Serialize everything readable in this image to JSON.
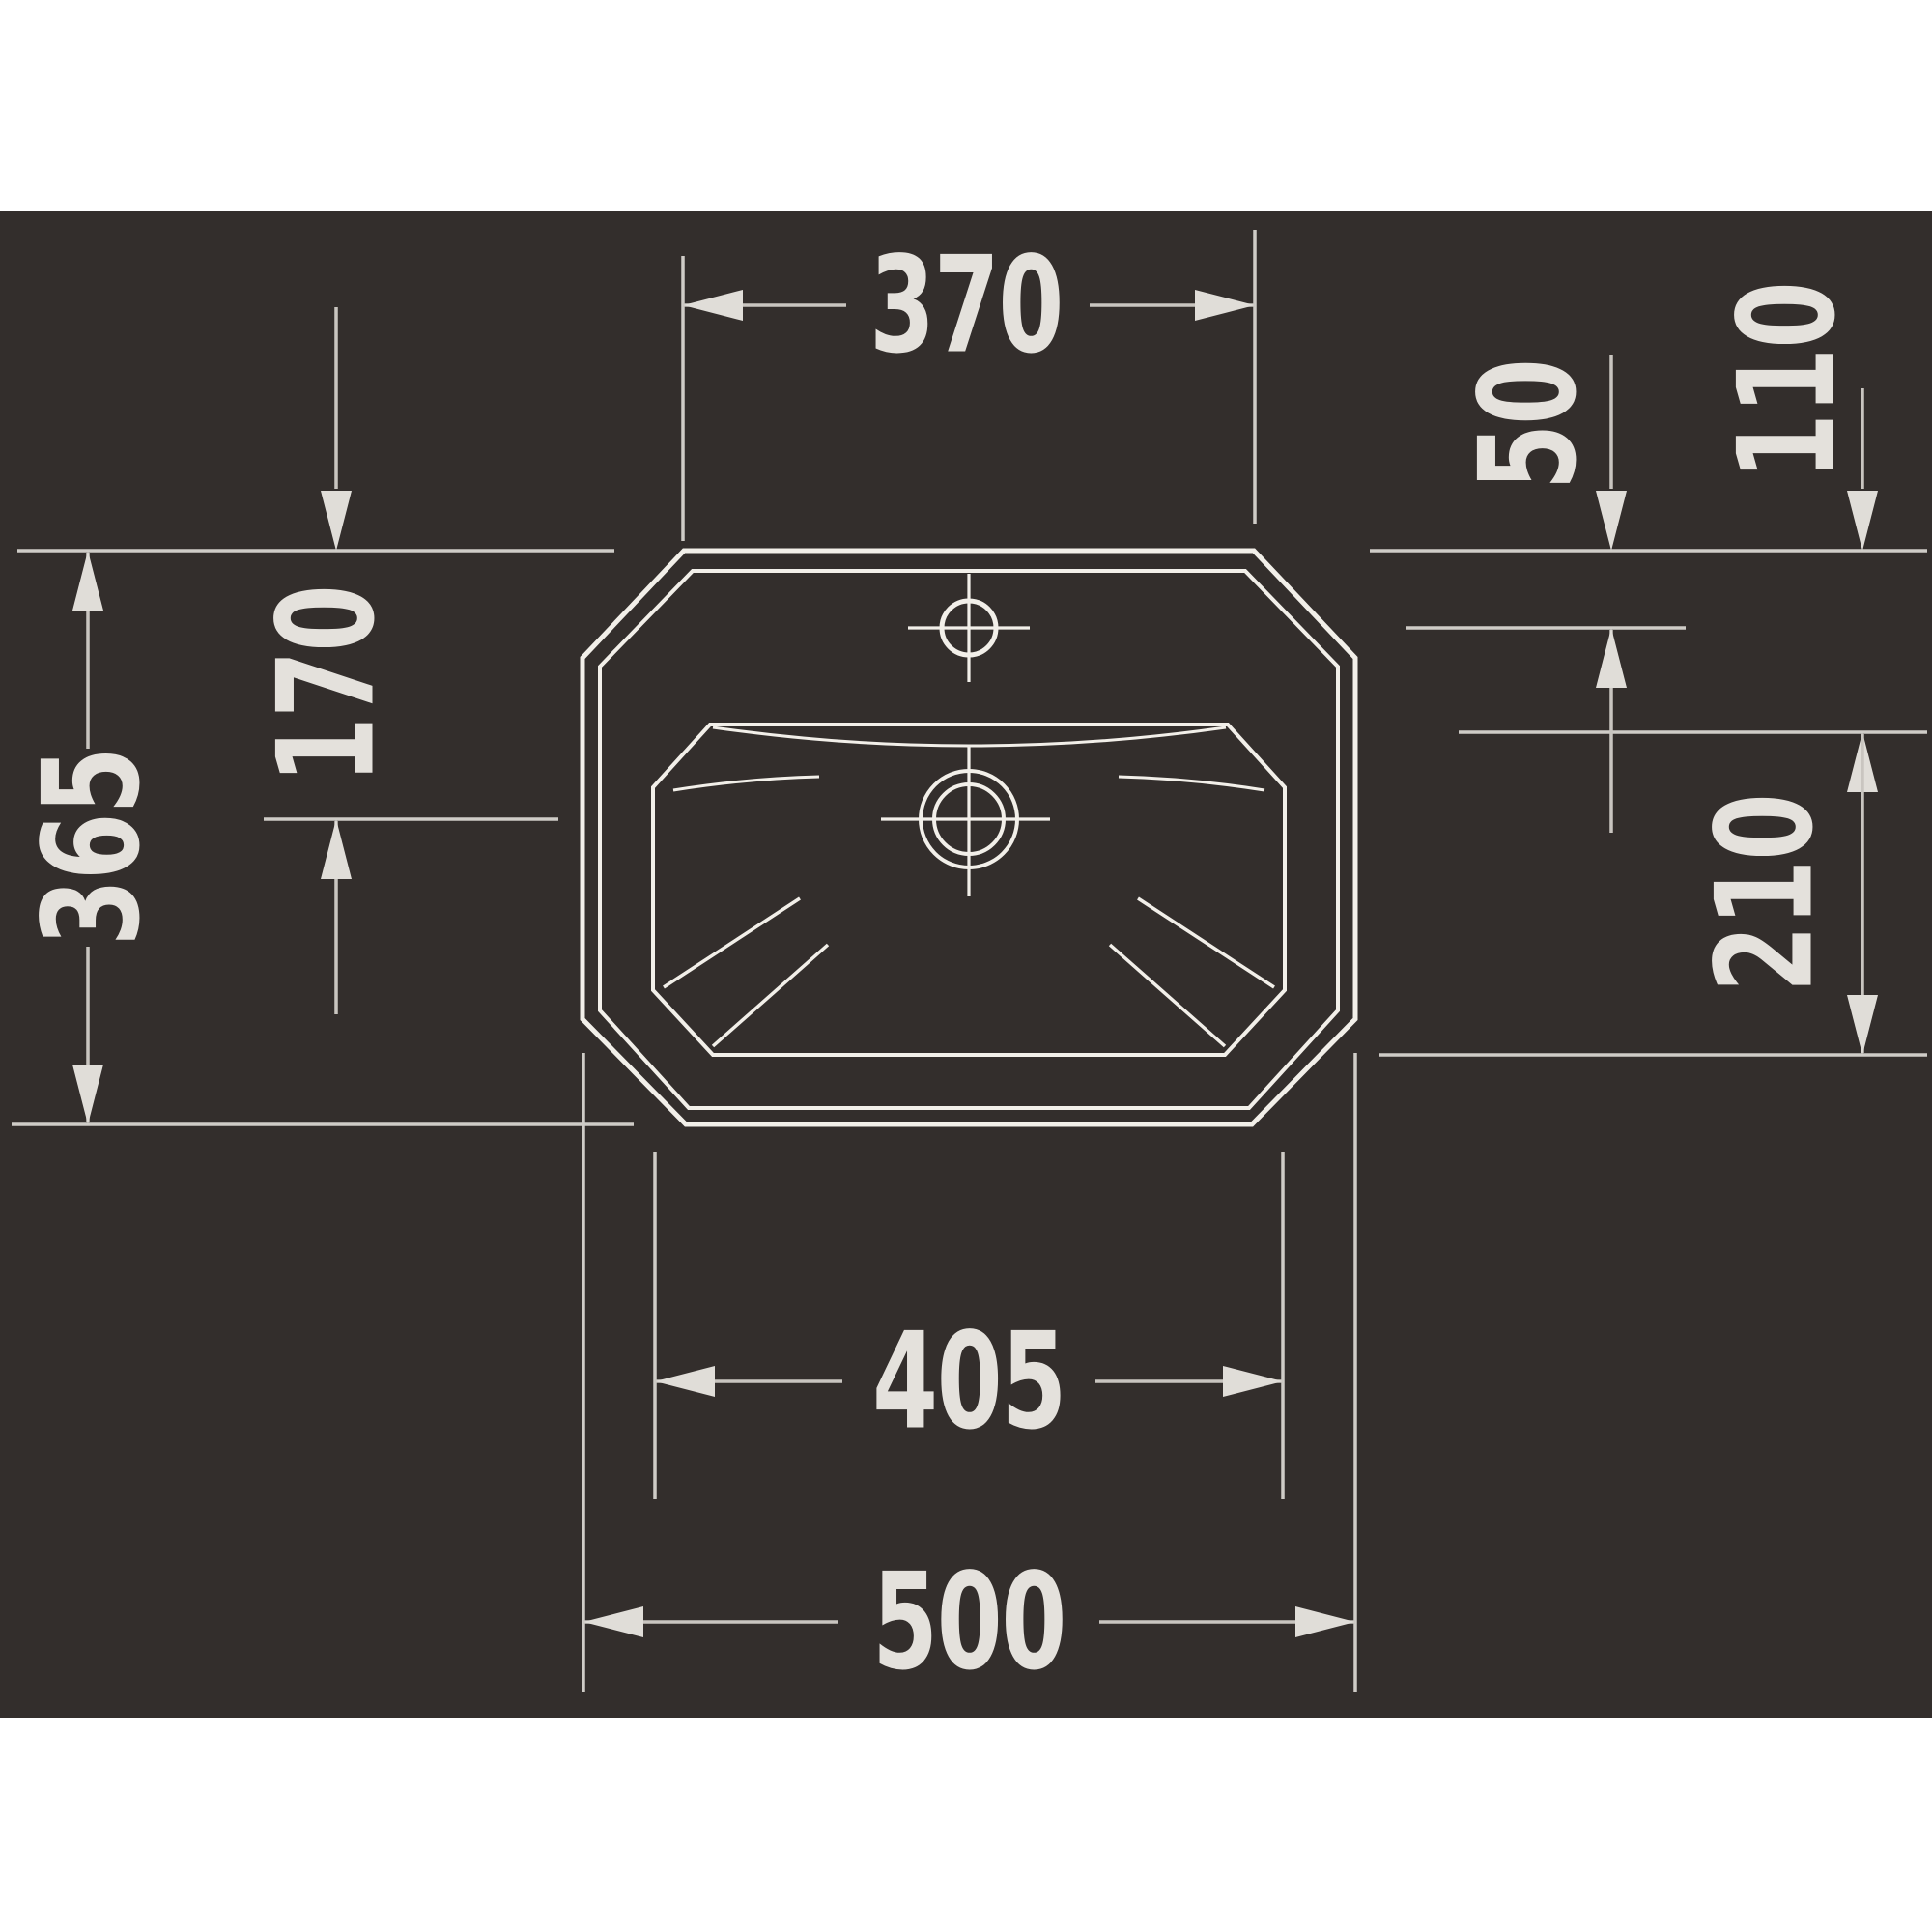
{
  "drawing": {
    "type": "technical-dimension-drawing",
    "view": "washbasin-top-view",
    "dimensions": {
      "top_edge_width": "370",
      "tap_hole_from_back_edge": "50",
      "basin_top_from_back_edge": "110",
      "drain_center_from_back_edge": "170",
      "overall_depth": "365",
      "basin_depth": "210",
      "basin_width": "405",
      "overall_width": "500"
    },
    "colors": {
      "page": "#ffffff",
      "background": "#332e2c",
      "outline": "#f2efe9",
      "dimline": "#c9c5c0",
      "extline": "#cfccc7",
      "dimtext": "#e4e1dc",
      "arrow": "#e0ddd8"
    }
  }
}
